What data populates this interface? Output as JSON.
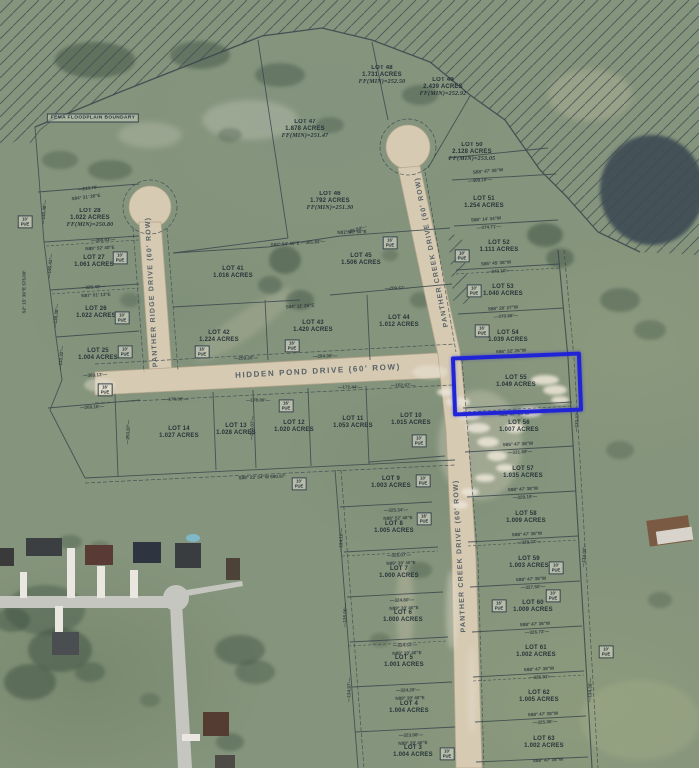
{
  "map": {
    "description": "Aerial subdivision plat map with highlighted lot",
    "highlight": {
      "lot": "LOT 55",
      "color": "#2023d6"
    },
    "fema_label": "FEMA FLOODPLAIN BOUNDARY",
    "streets": [
      {
        "id": "hidden-pond-drive",
        "name": "HIDDEN POND DRIVE (60' ROW)",
        "orientation": "horizontal",
        "x": 318,
        "y": 371,
        "rot": -3
      },
      {
        "id": "panther-ridge-drive",
        "name": "PANTHER RIDGE DRIVE (60' ROW)",
        "orientation": "vertical",
        "x": 152,
        "y": 292,
        "rot": -93
      },
      {
        "id": "panther-creek-drive-upper",
        "name": "PANTHER CREEK DRIVE (60' ROW)",
        "orientation": "vertical",
        "x": 432,
        "y": 252,
        "rot": -101
      },
      {
        "id": "panther-creek-drive-lower",
        "name": "PANTHER CREEK DRIVE (60' ROW)",
        "orientation": "vertical",
        "x": 460,
        "y": 556,
        "rot": -93
      }
    ],
    "lots": [
      {
        "name": "LOT 47",
        "acres": "1.878 ACRES",
        "ff": "FF(MIN)=251.47",
        "x": 305,
        "y": 130
      },
      {
        "name": "LOT 48",
        "acres": "1.731 ACRES",
        "ff": "FF(MIN)=252.50",
        "x": 382,
        "y": 76
      },
      {
        "name": "LOT 49",
        "acres": "2.439 ACRES",
        "ff": "FF(MIN)=252.92",
        "x": 443,
        "y": 88
      },
      {
        "name": "LOT 50",
        "acres": "2.128 ACRES",
        "ff": "FF(MIN)=253.05",
        "x": 472,
        "y": 153
      },
      {
        "name": "LOT 46",
        "acres": "1.792 ACRES",
        "ff": "FF(MIN)=251.30",
        "x": 330,
        "y": 202
      },
      {
        "name": "LOT 28",
        "acres": "1.022 ACRES",
        "ff": "FF(MIN)=250.80",
        "x": 90,
        "y": 219
      },
      {
        "name": "LOT 27",
        "acres": "1.061 ACRES",
        "x": 94,
        "y": 262
      },
      {
        "name": "LOT 26",
        "acres": "1.022 ACRES",
        "x": 96,
        "y": 313
      },
      {
        "name": "LOT 25",
        "acres": "1.004 ACRES",
        "x": 98,
        "y": 355
      },
      {
        "name": "LOT 41",
        "acres": "1.016 ACRES",
        "x": 233,
        "y": 273
      },
      {
        "name": "LOT 42",
        "acres": "1.224 ACRES",
        "x": 219,
        "y": 337
      },
      {
        "name": "LOT 43",
        "acres": "1.420 ACRES",
        "x": 313,
        "y": 327
      },
      {
        "name": "LOT 44",
        "acres": "1.012 ACRES",
        "x": 399,
        "y": 322
      },
      {
        "name": "LOT 45",
        "acres": "1.506 ACRES",
        "x": 361,
        "y": 260
      },
      {
        "name": "LOT 51",
        "acres": "1.254 ACRES",
        "x": 484,
        "y": 203
      },
      {
        "name": "LOT 52",
        "acres": "1.111 ACRES",
        "x": 499,
        "y": 247
      },
      {
        "name": "LOT 53",
        "acres": "1.040 ACRES",
        "x": 503,
        "y": 291
      },
      {
        "name": "LOT 54",
        "acres": "1.039 ACRES",
        "x": 508,
        "y": 337
      },
      {
        "name": "LOT 55",
        "acres": "1.049 ACRES",
        "x": 516,
        "y": 382,
        "highlighted": true
      },
      {
        "name": "LOT 56",
        "acres": "1.007 ACRES",
        "x": 519,
        "y": 427
      },
      {
        "name": "LOT 57",
        "acres": "1.035 ACRES",
        "x": 523,
        "y": 473
      },
      {
        "name": "LOT 58",
        "acres": "1.009 ACRES",
        "x": 526,
        "y": 518
      },
      {
        "name": "LOT 59",
        "acres": "1.003 ACRES",
        "x": 529,
        "y": 563
      },
      {
        "name": "LOT 60",
        "acres": "1.009 ACRES",
        "x": 533,
        "y": 607
      },
      {
        "name": "LOT 61",
        "acres": "1.002 ACRES",
        "x": 536,
        "y": 652
      },
      {
        "name": "LOT 62",
        "acres": "1.005 ACRES",
        "x": 539,
        "y": 697
      },
      {
        "name": "LOT 63",
        "acres": "1.002 ACRES",
        "x": 544,
        "y": 743
      },
      {
        "name": "LOT 14",
        "acres": "1.027 ACRES",
        "x": 179,
        "y": 433
      },
      {
        "name": "LOT 13",
        "acres": "1.028 ACRES",
        "x": 236,
        "y": 430
      },
      {
        "name": "LOT 12",
        "acres": "1.020 ACRES",
        "x": 294,
        "y": 427
      },
      {
        "name": "LOT 11",
        "acres": "1.053 ACRES",
        "x": 353,
        "y": 423
      },
      {
        "name": "LOT 10",
        "acres": "1.015 ACRES",
        "x": 411,
        "y": 420
      },
      {
        "name": "LOT 9",
        "acres": "1.003 ACRES",
        "x": 391,
        "y": 483
      },
      {
        "name": "LOT 8",
        "acres": "1.005 ACRES",
        "x": 394,
        "y": 528
      },
      {
        "name": "LOT 7",
        "acres": "1.000 ACRES",
        "x": 399,
        "y": 573
      },
      {
        "name": "LOT 6",
        "acres": "1.000 ACRES",
        "x": 403,
        "y": 617
      },
      {
        "name": "LOT 5",
        "acres": "1.001 ACRES",
        "x": 404,
        "y": 662
      },
      {
        "name": "LOT 4",
        "acres": "1.004 ACRES",
        "x": 409,
        "y": 708
      },
      {
        "name": "LOT 3",
        "acres": "1.004 ACRES",
        "x": 413,
        "y": 752
      }
    ],
    "pue_boxes": [
      {
        "label": "10'\nPUE",
        "x": 25,
        "y": 222
      },
      {
        "label": "10'\nPUE",
        "x": 120,
        "y": 258
      },
      {
        "label": "10'\nPUE",
        "x": 122,
        "y": 318
      },
      {
        "label": "10'\nPUE",
        "x": 125,
        "y": 352
      },
      {
        "label": "16'\nPUE",
        "x": 105,
        "y": 390
      },
      {
        "label": "16'\nPUE",
        "x": 202,
        "y": 352
      },
      {
        "label": "16'\nPUE",
        "x": 390,
        "y": 243
      },
      {
        "label": "16'\nPUE",
        "x": 292,
        "y": 346
      },
      {
        "label": "10'\nPUE",
        "x": 462,
        "y": 256
      },
      {
        "label": "10'\nPUE",
        "x": 474,
        "y": 291
      },
      {
        "label": "16'\nPUE",
        "x": 482,
        "y": 331
      },
      {
        "label": "16'\nPUE",
        "x": 286,
        "y": 406
      },
      {
        "label": "10'\nPUE",
        "x": 299,
        "y": 484
      },
      {
        "label": "10'\nPUE",
        "x": 419,
        "y": 441
      },
      {
        "label": "10'\nPUE",
        "x": 423,
        "y": 481
      },
      {
        "label": "16'\nPUE",
        "x": 424,
        "y": 519
      },
      {
        "label": "10'\nPUE",
        "x": 556,
        "y": 568
      },
      {
        "label": "10'\nPUE",
        "x": 553,
        "y": 596
      },
      {
        "label": "16'\nPUE",
        "x": 499,
        "y": 606
      },
      {
        "label": "10'\nPUE",
        "x": 606,
        "y": 652
      },
      {
        "label": "10'\nPUE",
        "x": 447,
        "y": 754
      }
    ],
    "dimensions": [
      {
        "text": "—210.76'—",
        "x": 90,
        "y": 188,
        "rot": -7
      },
      {
        "text": "S84° 31' 26\"E",
        "x": 86,
        "y": 197,
        "rot": -7
      },
      {
        "text": "—308.93'—",
        "x": 103,
        "y": 240,
        "rot": -3
      },
      {
        "text": "N89° 52' 40\"E",
        "x": 100,
        "y": 248,
        "rot": -3
      },
      {
        "text": "—325.43'—",
        "x": 93,
        "y": 287,
        "rot": -3
      },
      {
        "text": "N87° 01' 13\"E",
        "x": 96,
        "y": 295,
        "rot": -3
      },
      {
        "text": "—303.13'—",
        "x": 95,
        "y": 375,
        "rot": -3
      },
      {
        "text": "—269.16'—",
        "x": 92,
        "y": 407,
        "rot": -3
      },
      {
        "text": "S2° 15' 36\"E  575.00'",
        "x": 24,
        "y": 292,
        "rot": -90
      },
      {
        "text": "—140.48'—",
        "x": 44,
        "y": 212,
        "rot": -85
      },
      {
        "text": "—146.43'—",
        "x": 50,
        "y": 266,
        "rot": -85
      },
      {
        "text": "—138.38'—",
        "x": 56,
        "y": 316,
        "rot": -85
      },
      {
        "text": "—133.32'—",
        "x": 61,
        "y": 358,
        "rot": -85
      },
      {
        "text": "—176.00'—",
        "x": 176,
        "y": 399,
        "rot": 0
      },
      {
        "text": "—178.00'—",
        "x": 258,
        "y": 400,
        "rot": 0
      },
      {
        "text": "—172.44'—",
        "x": 350,
        "y": 387,
        "rot": 0
      },
      {
        "text": "—152.67'—",
        "x": 403,
        "y": 385,
        "rot": 0
      },
      {
        "text": "S88° 22' 54\"W  880.97'",
        "x": 262,
        "y": 477,
        "rot": -2
      },
      {
        "text": "—294.98'—",
        "x": 325,
        "y": 356,
        "rot": -2
      },
      {
        "text": "—209.57'—",
        "x": 397,
        "y": 288,
        "rot": 0
      },
      {
        "text": "N87° 45' 50\"E",
        "x": 352,
        "y": 232,
        "rot": -2
      },
      {
        "text": "S82° 54' 46\"E —381.82'—",
        "x": 298,
        "y": 243,
        "rot": -4
      },
      {
        "text": "S84° 11' 26\"E",
        "x": 300,
        "y": 306,
        "rot": -4
      },
      {
        "text": "—259.20'—",
        "x": 246,
        "y": 358,
        "rot": -2
      },
      {
        "text": "—575.84'—",
        "x": 355,
        "y": 230,
        "rot": -18
      },
      {
        "text": "S88° 47' 38\"W",
        "x": 488,
        "y": 171,
        "rot": -5
      },
      {
        "text": "—409.18'—",
        "x": 480,
        "y": 180,
        "rot": -5
      },
      {
        "text": "S88° 14' 34\"W",
        "x": 486,
        "y": 219,
        "rot": -4
      },
      {
        "text": "—374.71'—",
        "x": 489,
        "y": 227,
        "rot": -4
      },
      {
        "text": "S85° 45' 38\"W",
        "x": 496,
        "y": 263,
        "rot": -4
      },
      {
        "text": "—343.10'—",
        "x": 499,
        "y": 271,
        "rot": -4
      },
      {
        "text": "S88° 20' 27\"W",
        "x": 503,
        "y": 308,
        "rot": -4
      },
      {
        "text": "—370.66'—",
        "x": 506,
        "y": 316,
        "rot": -4
      },
      {
        "text": "S86° 32' 26\"W",
        "x": 511,
        "y": 351,
        "rot": -3
      },
      {
        "text": "S86° 47' 35\"W",
        "x": 514,
        "y": 414,
        "rot": -3
      },
      {
        "text": "S85° 47' 38\"W",
        "x": 518,
        "y": 444,
        "rot": -3
      },
      {
        "text": "—331.69'—",
        "x": 520,
        "y": 452,
        "rot": -3
      },
      {
        "text": "S88° 47' 38\"W",
        "x": 523,
        "y": 489,
        "rot": -3
      },
      {
        "text": "—329.19'—",
        "x": 525,
        "y": 497,
        "rot": -3
      },
      {
        "text": "S88° 47' 38\"W",
        "x": 527,
        "y": 534,
        "rot": -3
      },
      {
        "text": "—328.37'—",
        "x": 529,
        "y": 542,
        "rot": -3
      },
      {
        "text": "S88° 47' 38\"W",
        "x": 531,
        "y": 579,
        "rot": -3
      },
      {
        "text": "—327.50'—",
        "x": 533,
        "y": 587,
        "rot": -3
      },
      {
        "text": "S88° 47' 38\"W",
        "x": 535,
        "y": 624,
        "rot": -3
      },
      {
        "text": "—326.73'—",
        "x": 537,
        "y": 632,
        "rot": -3
      },
      {
        "text": "S88° 47' 38\"W",
        "x": 539,
        "y": 669,
        "rot": -3
      },
      {
        "text": "—325.91'—",
        "x": 541,
        "y": 677,
        "rot": -3
      },
      {
        "text": "S88° 47' 38\"W",
        "x": 543,
        "y": 714,
        "rot": -3
      },
      {
        "text": "—325.06'—",
        "x": 545,
        "y": 722,
        "rot": -3
      },
      {
        "text": "S88° 47' 38\"W",
        "x": 548,
        "y": 760,
        "rot": -3
      },
      {
        "text": "—325.34'—",
        "x": 396,
        "y": 510,
        "rot": -2
      },
      {
        "text": "N88° 52' 40\"E",
        "x": 398,
        "y": 518,
        "rot": -2
      },
      {
        "text": "—325.07'—",
        "x": 399,
        "y": 555,
        "rot": -2
      },
      {
        "text": "N89° 39' 40\"E",
        "x": 401,
        "y": 563,
        "rot": -2
      },
      {
        "text": "—324.80'—",
        "x": 402,
        "y": 600,
        "rot": -2
      },
      {
        "text": "N89° 39' 40\"E",
        "x": 404,
        "y": 608,
        "rot": -2
      },
      {
        "text": "—324.53'—",
        "x": 405,
        "y": 645,
        "rot": -2
      },
      {
        "text": "N89° 39' 40\"E",
        "x": 407,
        "y": 653,
        "rot": -2
      },
      {
        "text": "—324.26'—",
        "x": 408,
        "y": 690,
        "rot": -2
      },
      {
        "text": "N89° 39' 40\"E",
        "x": 410,
        "y": 698,
        "rot": -2
      },
      {
        "text": "—323.98'—",
        "x": 411,
        "y": 735,
        "rot": -2
      },
      {
        "text": "N89° 39' 40\"E",
        "x": 413,
        "y": 743,
        "rot": -2
      },
      {
        "text": "—133.37'—",
        "x": 577,
        "y": 420,
        "rot": -86
      },
      {
        "text": "—134.02'—",
        "x": 584,
        "y": 555,
        "rot": -87
      },
      {
        "text": "—134.36'—",
        "x": 590,
        "y": 690,
        "rot": -88
      },
      {
        "text": "—134.10'—",
        "x": 341,
        "y": 540,
        "rot": -88
      },
      {
        "text": "—135.00'—",
        "x": 345,
        "y": 615,
        "rot": -88
      },
      {
        "text": "—134.97'—",
        "x": 349,
        "y": 690,
        "rot": -88
      },
      {
        "text": "—253.87'—",
        "x": 128,
        "y": 432,
        "rot": -87
      },
      {
        "text": "—254.07'—",
        "x": 252,
        "y": 428,
        "rot": -87
      }
    ]
  }
}
